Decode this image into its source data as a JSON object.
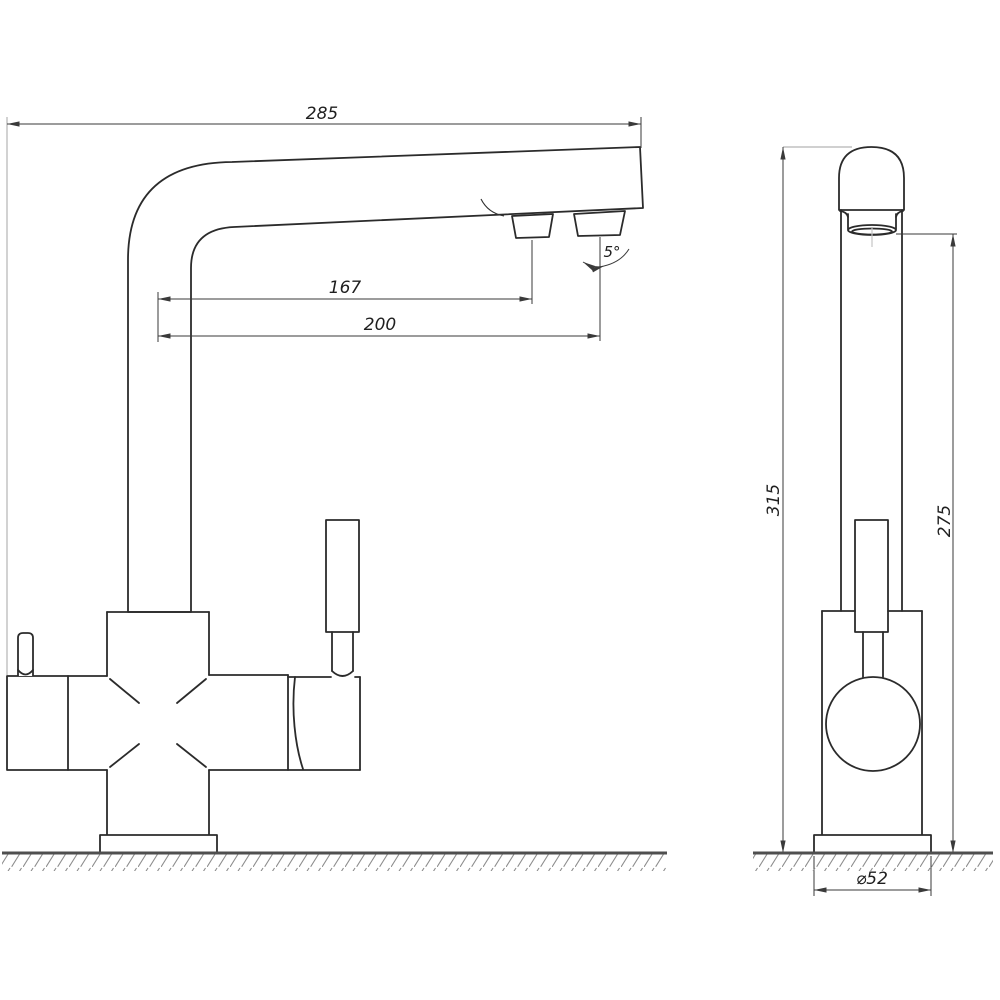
{
  "drawing": {
    "dimensions": {
      "overall_reach": "285",
      "nozzle1_reach": "167",
      "nozzle2_reach": "200",
      "nozzle_angle": "5°",
      "overall_height": "315",
      "outlet_height": "275",
      "base_diameter": "⌀52"
    },
    "colors": {
      "object_line": "#2b2b2b",
      "dimension_line": "#3a3a3a",
      "extension_line": "#b4b4b4",
      "ground_line": "#4f4f4f",
      "hatch_line": "#8c8c8c",
      "background": "#ffffff"
    }
  }
}
